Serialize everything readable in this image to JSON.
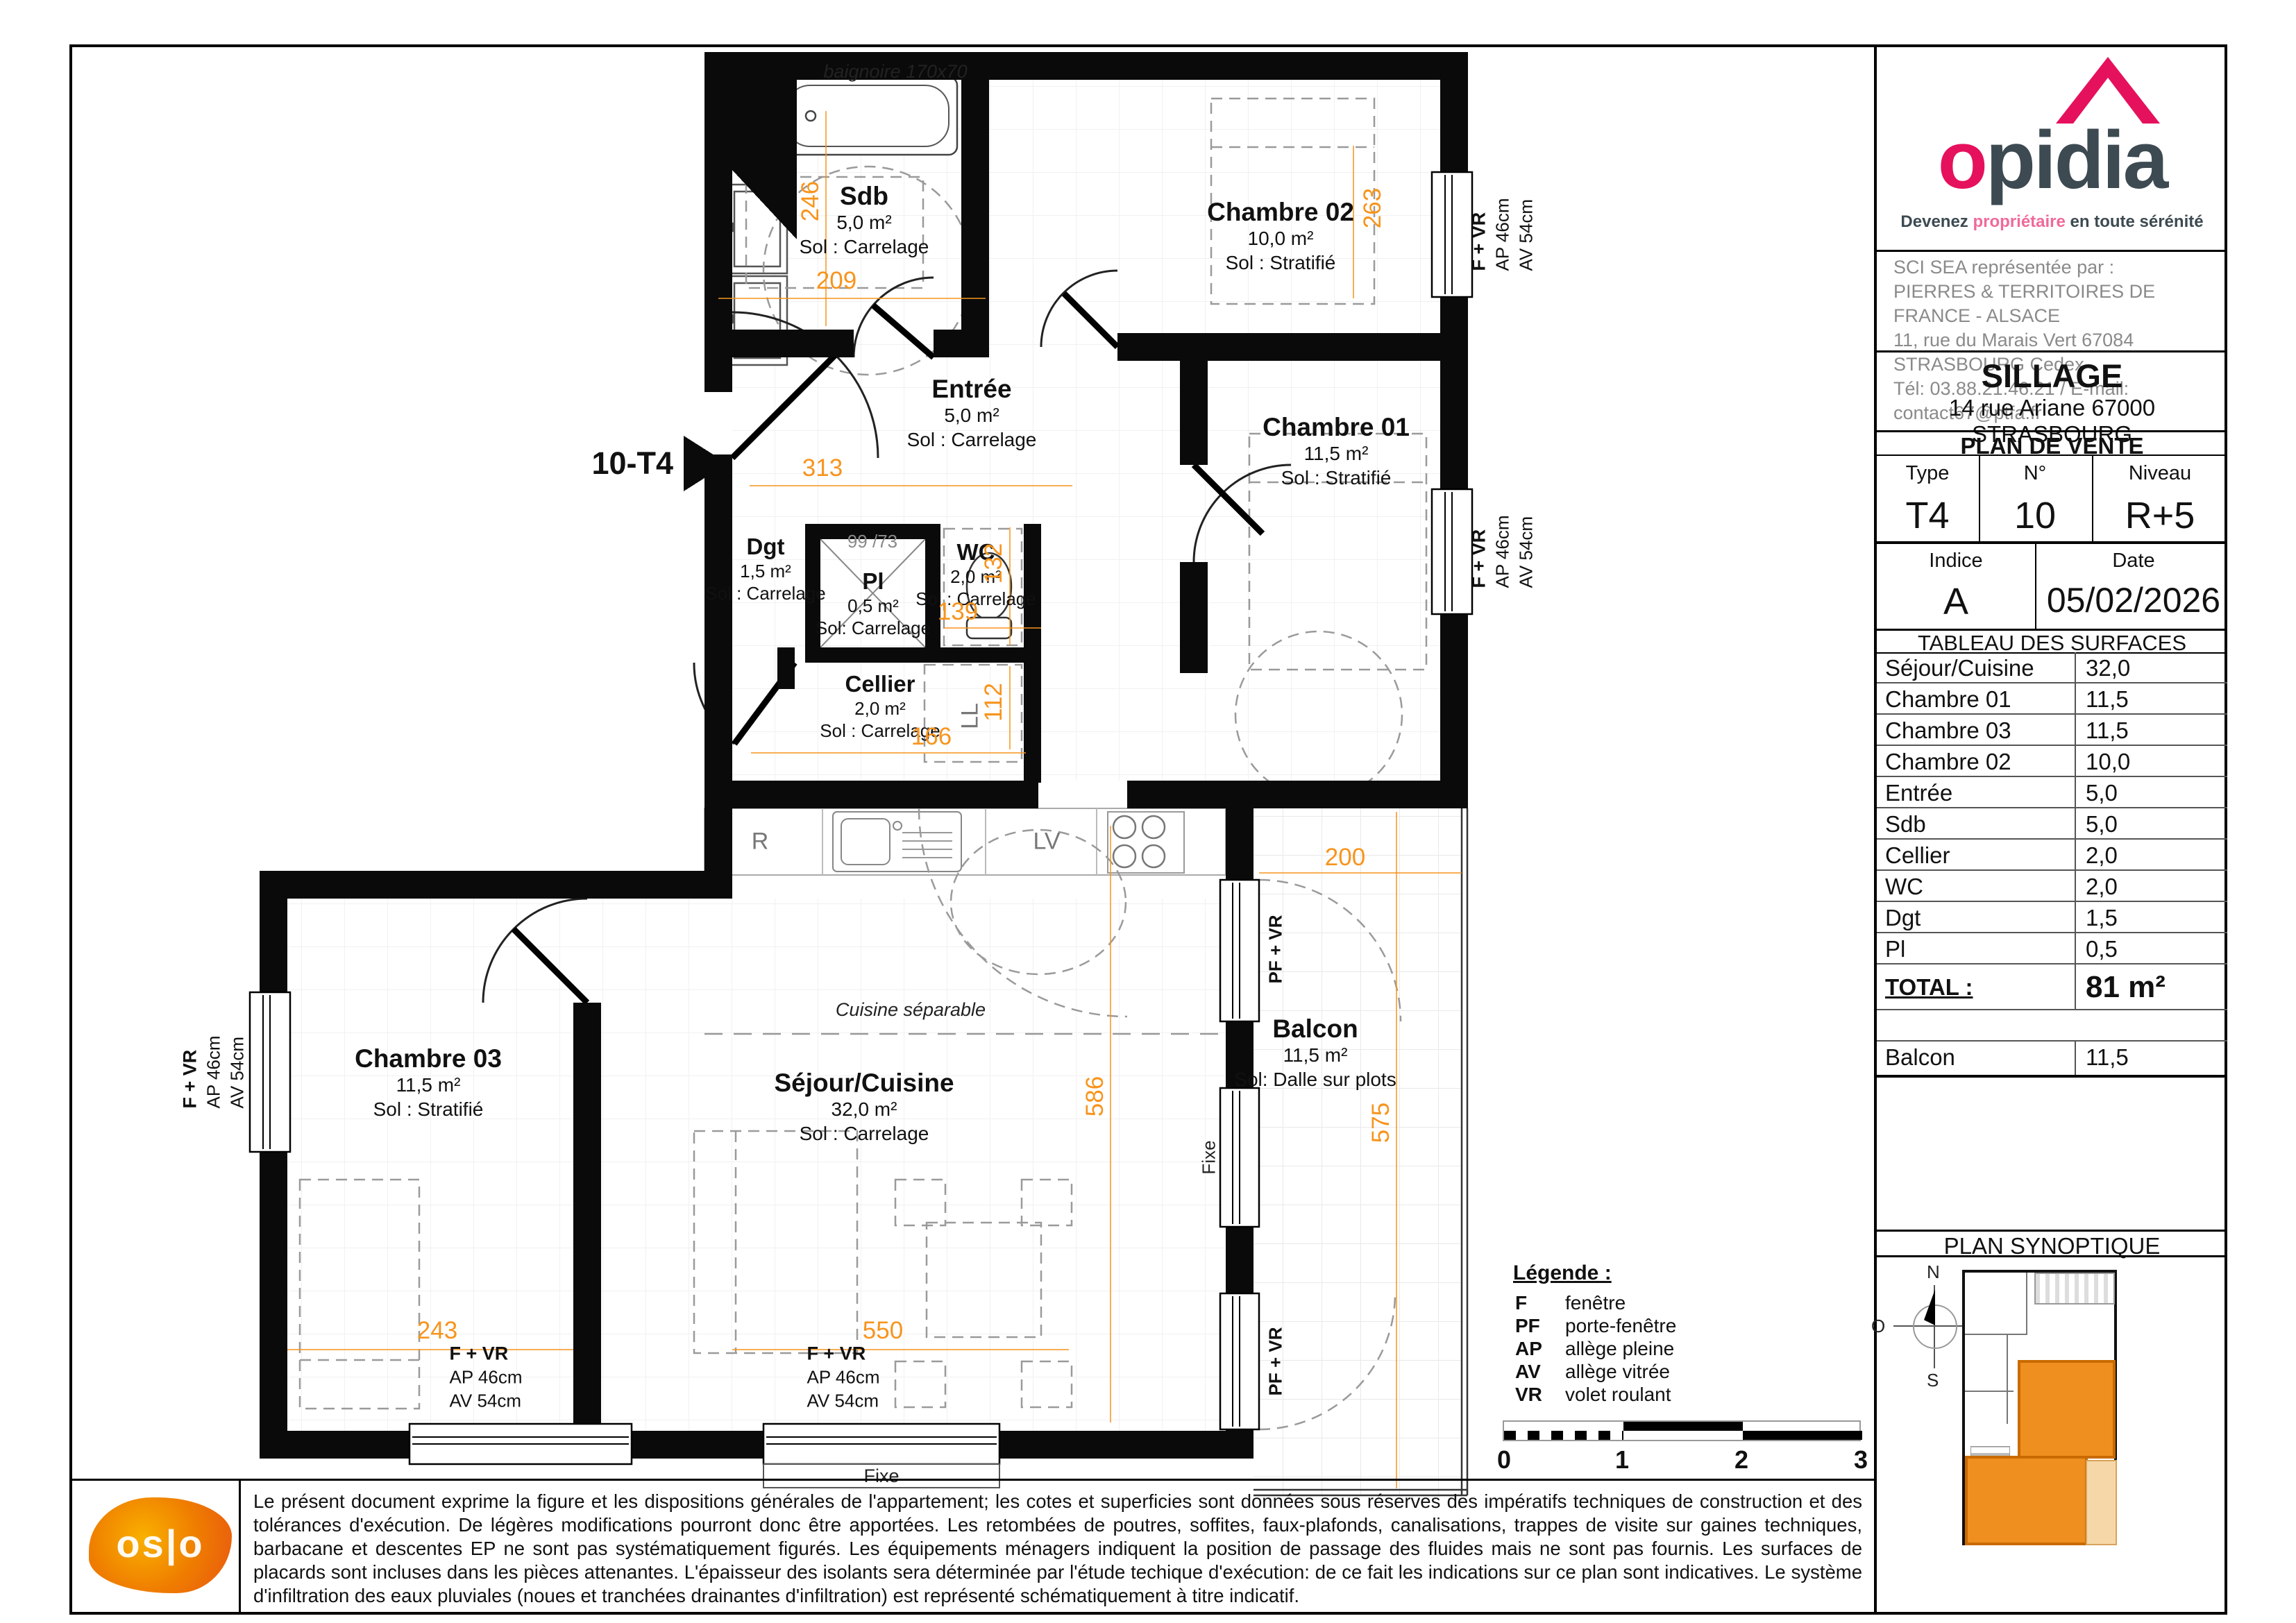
{
  "brand": {
    "logo_text_pre": "o",
    "logo_text_rest": "pidia",
    "tagline_prefix": "Devenez ",
    "tagline_highlight": "propriétaire",
    "tagline_suffix": " en toute sérénité",
    "colors": {
      "pink": "#e5115d",
      "dark": "#3d4a52",
      "dim_orange": "#f7941d",
      "apartment_orange": "#ef8f1f"
    }
  },
  "agency": {
    "line1": "SCI SEA représentée par :",
    "line2": "PIERRES & TERRITOIRES DE FRANCE - ALSACE",
    "line3": "11, rue du Marais Vert 67084 STRASBOURG Cedex",
    "line4": "Tél: 03.88.21.46.21 / E-mail: contact67@ptfa.fr"
  },
  "project": {
    "name": "SILLAGE",
    "address": "14 rue Ariane 67000 STRASBOURG"
  },
  "plan_de_vente": {
    "title": "PLAN DE VENTE",
    "type_label": "Type",
    "type_value": "T4",
    "num_label": "N°",
    "num_value": "10",
    "niveau_label": "Niveau",
    "niveau_value": "R+5",
    "indice_label": "Indice",
    "indice_value": "A",
    "date_label": "Date",
    "date_value": "05/02/2026"
  },
  "surfaces": {
    "title": "TABLEAU DES SURFACES",
    "rows": [
      {
        "label": "Séjour/Cuisine",
        "value": "32,0"
      },
      {
        "label": "Chambre 01",
        "value": "11,5"
      },
      {
        "label": "Chambre 03",
        "value": "11,5"
      },
      {
        "label": "Chambre 02",
        "value": "10,0"
      },
      {
        "label": "Entrée",
        "value": "5,0"
      },
      {
        "label": "Sdb",
        "value": "5,0"
      },
      {
        "label": "Cellier",
        "value": "2,0"
      },
      {
        "label": "WC",
        "value": "2,0"
      },
      {
        "label": "Dgt",
        "value": "1,5"
      },
      {
        "label": "Pl",
        "value": "0,5"
      }
    ],
    "total_label": "TOTAL :",
    "total_value": "81 m²",
    "balcon_label": "Balcon",
    "balcon_value": "11,5"
  },
  "plan": {
    "unit_marker": "10-T4",
    "rooms": [
      {
        "name": "Sdb",
        "area": "5,0 m²",
        "floor": "Sol : Carrelage"
      },
      {
        "name": "Chambre 02",
        "area": "10,0 m²",
        "floor": "Sol : Stratifié"
      },
      {
        "name": "Entrée",
        "area": "5,0 m²",
        "floor": "Sol : Carrelage"
      },
      {
        "name": "Chambre 01",
        "area": "11,5 m²",
        "floor": "Sol : Stratifié"
      },
      {
        "name": "Dgt",
        "area": "1,5 m²",
        "floor": "Sol : Carrelage"
      },
      {
        "name": "Pl",
        "area": "0,5 m²",
        "floor": "Sol: Carrelage"
      },
      {
        "name": "WC",
        "area": "2,0 m²",
        "floor": "Sol : Carrelage"
      },
      {
        "name": "Cellier",
        "area": "2,0 m²",
        "floor": "Sol : Carrelage"
      },
      {
        "name": "Chambre 03",
        "area": "11,5 m²",
        "floor": "Sol : Stratifié"
      },
      {
        "name": "Séjour/Cuisine",
        "area": "32,0 m²",
        "floor": "Sol : Carrelage"
      },
      {
        "name": "Balcon",
        "area": "11,5 m²",
        "floor": "Sol: Dalle sur plots"
      }
    ],
    "annotations": {
      "bathtub": "baignoire 170x70",
      "closet_dims": "99 /73",
      "kitchen_note": "Cuisine séparable",
      "fridge": "R",
      "dishwasher": "LV",
      "washer": "LL",
      "fixe": "Fixe"
    },
    "window_label": {
      "l1": "F + VR",
      "l2": "AP 46cm",
      "l3": "AV 54cm"
    },
    "door_window_label": "PF + VR",
    "dims": {
      "sdb_h": "246",
      "sdb_w": "209",
      "entree_w": "313",
      "ch02_h": "263",
      "wc_h": "132",
      "wc_w": "139",
      "cellier_w": "166",
      "cellier_h": "112",
      "sejour_h": "586",
      "balcon_h": "575",
      "balcon_w": "200",
      "sejour_w": "550",
      "ch03_w": "243"
    }
  },
  "legend": {
    "title": "Légende :",
    "items": [
      {
        "abbr": "F",
        "label": "fenêtre"
      },
      {
        "abbr": "PF",
        "label": "porte-fenêtre"
      },
      {
        "abbr": "AP",
        "label": "allège pleine"
      },
      {
        "abbr": "AV",
        "label": "allège vitrée"
      },
      {
        "abbr": "VR",
        "label": "volet roulant"
      }
    ]
  },
  "scale_bar": {
    "t0": "0",
    "t1": "1",
    "t2": "2",
    "t3": "3"
  },
  "synoptique": {
    "title": "PLAN SYNOPTIQUE",
    "compass": {
      "n": "N",
      "e": "E",
      "s": "S",
      "o": "O"
    }
  },
  "footer": {
    "oslo": "os|o",
    "disclaimer": "Le présent document exprime la figure et les dispositions générales de l'appartement; les cotes et superficies sont données sous réserves des impératifs techniques de construction et des tolérances d'exécution. De légères modifications pourront donc être apportées. Les retombées de poutres, soffites, faux-plafonds, canalisations, trappes de visite sur gaines techniques, barbacane et descentes EP ne sont pas systématiquement figurés. Les équipements ménagers indiquent la position de passage des fluides mais ne sont pas fournis. Les surfaces de placards sont incluses dans les pièces attenantes. L'épaisseur des isolants sera déterminée par l'étude techique d'exécution: de ce fait les indications sur ce plan sont indicatives. Le système d'infiltration des eaux pluviales (noues et tranchées drainantes d'infiltration) est représenté schématiquement à titre indicatif."
  }
}
